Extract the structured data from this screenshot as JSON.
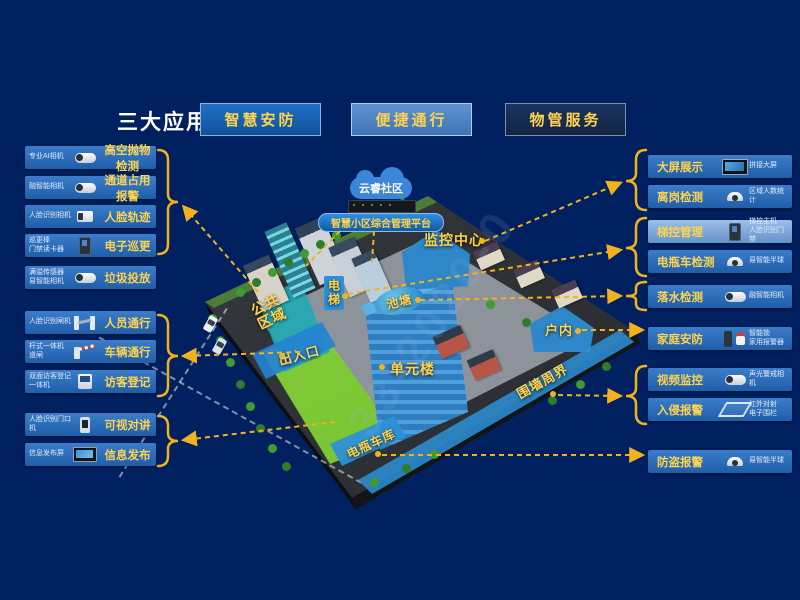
{
  "app": {
    "background_color": "#01205F",
    "accent_yellow": "#FFD34D",
    "arrow_color": "#F2B21D",
    "row_blue": "#2A6CB8",
    "highlight_row_blue": "#9CC0E8",
    "watermark": "33-2020-0"
  },
  "header": {
    "title": "三大应用",
    "buttons": [
      {
        "label": "智慧安防"
      },
      {
        "label": "便捷通行"
      },
      {
        "label": "物管服务"
      }
    ]
  },
  "left_panel": {
    "rows": [
      {
        "device": "专业AI相机",
        "function": "高空抛物检测"
      },
      {
        "device": "融智能相机",
        "function": "通道占用报警"
      },
      {
        "device": "人脸识别相机",
        "function": "人脸轨迹"
      },
      {
        "device": "巡更棒\n门禁读卡器",
        "function": "电子巡更"
      },
      {
        "device": "满溢传感器\n易智能相机",
        "function": "垃圾投放"
      },
      {
        "device": "人脸识别闸机",
        "function": "人员通行"
      },
      {
        "device": "杆式一体机\n道闸",
        "function": "车辆通行"
      },
      {
        "device": "双面访客登记\n一体机",
        "function": "访客登记"
      },
      {
        "device": "人脸识别门口\n机",
        "function": "可视对讲"
      },
      {
        "device": "信息发布屏",
        "function": "信息发布"
      }
    ]
  },
  "right_panel": {
    "rows": [
      {
        "function": "大屏展示",
        "device": "拼接大屏"
      },
      {
        "function": "离岗检测",
        "device": "区域人数统计"
      },
      {
        "function": "梯控管理",
        "device": "梯控主机\n人脸识别门禁"
      },
      {
        "function": "电瓶车检测",
        "device": "易智能半球"
      },
      {
        "function": "落水检测",
        "device": "融智能相机"
      },
      {
        "function": "家庭安防",
        "device": "智能锁\n家用报警器"
      },
      {
        "function": "视频监控",
        "device": "声光警戒相机"
      },
      {
        "function": "入侵报警",
        "device": "红外对射\n电子围栏"
      },
      {
        "function": "防盗报警",
        "device": "易智能半球"
      }
    ]
  },
  "map": {
    "cloud_label": "云睿社区",
    "platform_label": "智慧小区综合管理平台",
    "zones": {
      "monitor_center": "监控中心",
      "elevator": "电梯",
      "pond": "池塘",
      "public_area": "公共区域",
      "entrance": "出入口",
      "unit_building": "单元楼",
      "indoor": "户内",
      "perimeter": "围墙周界",
      "bike_garage": "电瓶车库"
    }
  }
}
